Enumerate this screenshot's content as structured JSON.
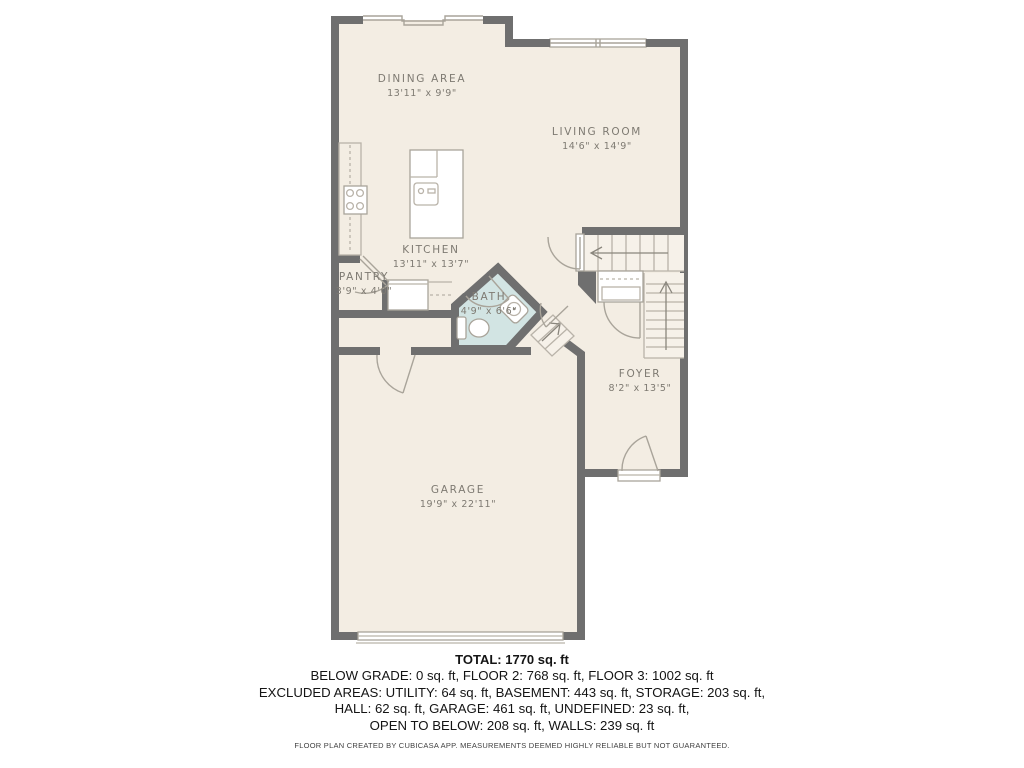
{
  "plan": {
    "rooms": [
      {
        "name": "DINING AREA",
        "dims": "13'11\" x 9'9\""
      },
      {
        "name": "LIVING ROOM",
        "dims": "14'6\" x 14'9\""
      },
      {
        "name": "KITCHEN",
        "dims": "13'11\" x 13'7\""
      },
      {
        "name": "PANTRY",
        "dims": "3'9\" x 4'0\""
      },
      {
        "name": "BATH",
        "dims": "4'9\" x 6'6\""
      },
      {
        "name": "FOYER",
        "dims": "8'2\" x 13'5\""
      },
      {
        "name": "GARAGE",
        "dims": "19'9\" x 22'11\""
      }
    ]
  },
  "summary": {
    "total": "TOTAL: 1770 sq. ft",
    "line1": "BELOW GRADE: 0 sq. ft, FLOOR 2: 768 sq. ft, FLOOR 3: 1002 sq. ft",
    "line2": "EXCLUDED AREAS: UTILITY: 64 sq. ft, BASEMENT: 443 sq. ft, STORAGE: 203 sq. ft,",
    "line3": "HALL: 62 sq. ft, GARAGE: 461 sq. ft, UNDEFINED: 23 sq. ft,",
    "line4": "OPEN TO BELOW: 208 sq. ft, WALLS: 239 sq. ft",
    "disclaimer": "FLOOR PLAN CREATED BY CUBICASA APP. MEASUREMENTS DEEMED HIGHLY RELIABLE BUT NOT GUARANTEED."
  },
  "colors": {
    "wall": "#6f6f6f",
    "floor": "#f3ede3",
    "bath": "#d2e4e3",
    "fixture": "#b9b3a9",
    "label": "#7e7a72",
    "ink": "#141414"
  }
}
